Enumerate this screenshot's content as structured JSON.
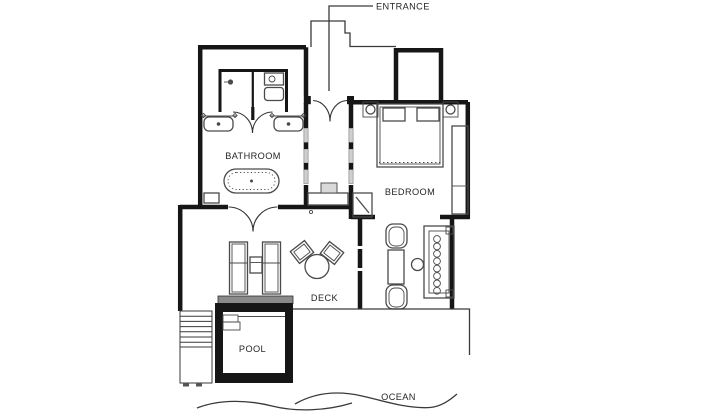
{
  "plan": {
    "title": "villa floor plan",
    "labels": {
      "entrance": "ENTRANCE",
      "bathroom": "BATHROOM",
      "bedroom": "BEDROOM",
      "deck": "DECK",
      "pool": "POOL",
      "ocean": "OCEAN"
    },
    "colors": {
      "wall": "#161616",
      "line": "#3a3a3a",
      "furn": "#4a4a4a",
      "window": "#cfcfcf",
      "coping": "#8a8a8a",
      "label": "#262626",
      "bg": "#ffffff"
    }
  }
}
